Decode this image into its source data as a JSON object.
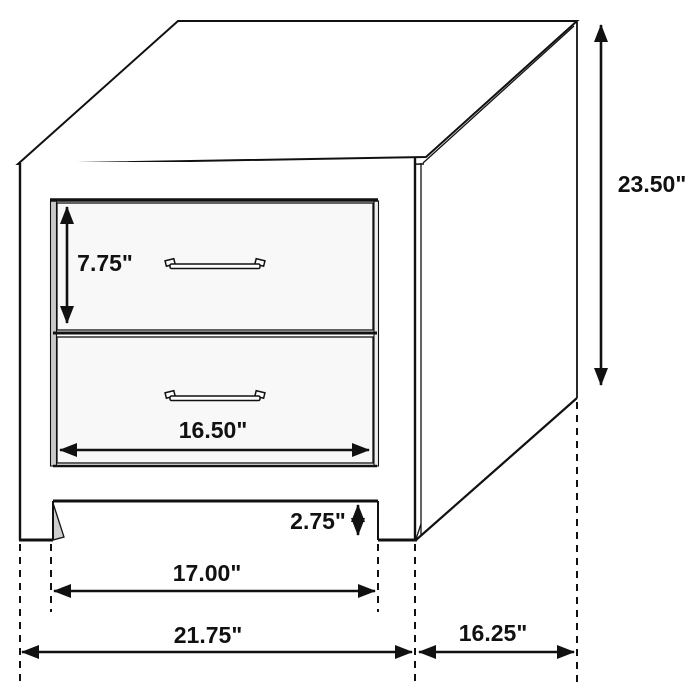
{
  "drawing": {
    "subject": "two-drawer-nightstand-line-drawing",
    "colors": {
      "line": "#111111",
      "background": "#ffffff",
      "drawer_face": "#f8f8f8",
      "reveal_shadow": "#c9c9c9"
    }
  },
  "dimensions": {
    "overall_height": "23.50\"",
    "drawer_height": "7.75\"",
    "drawer_width": "16.50\"",
    "base_clearance": "2.75\"",
    "between_legs_width": "17.00\"",
    "overall_width": "21.75\"",
    "side_depth": "16.25\""
  }
}
